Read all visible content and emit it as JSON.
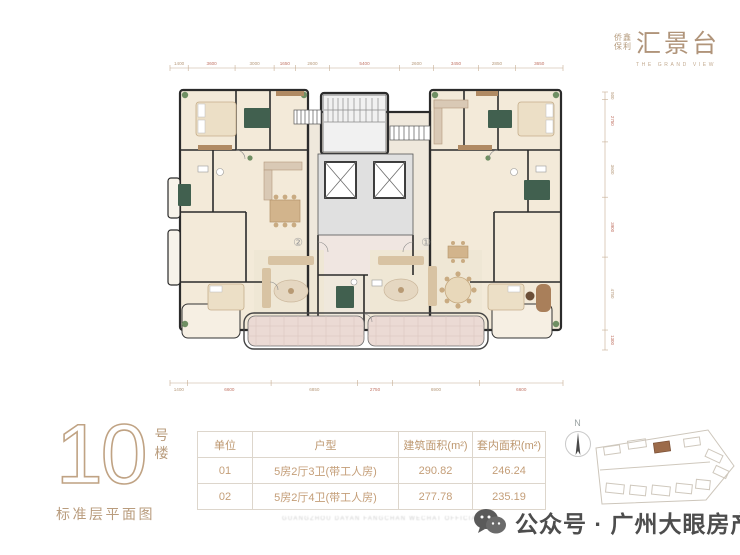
{
  "logo": {
    "brand_small_top": "侨鑫",
    "brand_small_bottom": "保利",
    "title": "汇景台",
    "tagline": "THE GRAND VIEW"
  },
  "block": {
    "number": "10",
    "suffix_char1": "号",
    "suffix_char2": "楼",
    "caption": "标准层平面图"
  },
  "plan": {
    "unit_right_label": "①",
    "unit_left_label": "②",
    "dims_top": [
      "1400",
      "3600",
      "3000",
      "1650",
      "2600",
      "5400",
      "2600",
      "3450",
      "2850",
      "3650"
    ],
    "dims_bottom": [
      "1400",
      "6600",
      "6850",
      "2750",
      "6900",
      "6600"
    ],
    "dims_right": [
      "500",
      "2750",
      "3600",
      "3900",
      "4750",
      "1300"
    ]
  },
  "table": {
    "headers": [
      "单位",
      "户型",
      "建筑面积(m²)",
      "套内面积(m²)"
    ],
    "rows": [
      [
        "01",
        "5房2厅3卫(带工人房)",
        "290.82",
        "246.24"
      ],
      [
        "02",
        "5房2厅4卫(带工人房)",
        "277.78",
        "235.19"
      ]
    ]
  },
  "compass": {
    "label": "N"
  },
  "watermark": "GUANGZHOU DAYAN FANGCHAN WECHAT OFFICIAL ACCOUNT",
  "footer": {
    "account_line": "公众号 · 广州大眼房产"
  },
  "colors": {
    "brand_tan": "#b99c7d",
    "table_text": "#c49e78",
    "dim_tan": "#b79a7c",
    "dim_red": "#c17465",
    "wall": "#2b2b2b",
    "room_cream": "#f3ead9",
    "balcony_pink": "#ebdad4",
    "plant_green": "#6f8f63",
    "accent_green": "#41604f",
    "footer_gray": "#4d4d4d"
  }
}
